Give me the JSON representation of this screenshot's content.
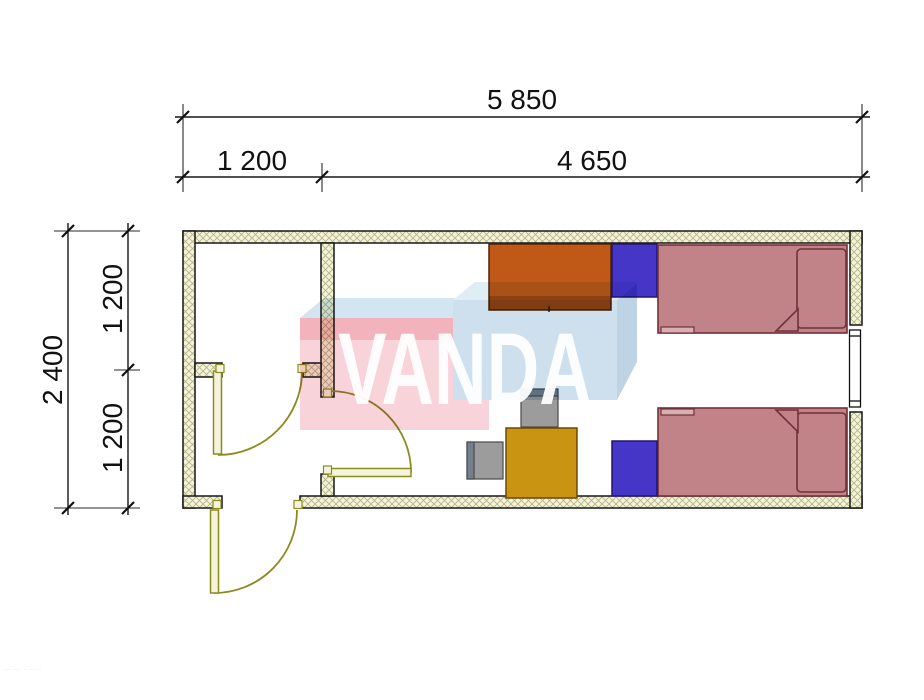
{
  "drawing": {
    "type": "floor-plan",
    "watermark": {
      "text": "VANDA",
      "letters_color": "#ffffff",
      "pink_front": "#f8cfd6",
      "pink_band": "#f2abb5",
      "pink_top": "#cfe2ef",
      "blue_front": "#c9dcec",
      "blue_top": "#dcebf4",
      "blue_side": "#b7d0e2"
    },
    "dimensions": {
      "top_total": "5 850",
      "top_segment_left": "1 200",
      "top_segment_right": "4 650",
      "side_total": "2 400",
      "side_segment_upper": "1 200",
      "side_segment_lower": "1 200"
    },
    "fine_print": "···· ··· ·· ·· ··",
    "palette": {
      "wall_fill": "#f4f4dc",
      "wall_hatch": "#b5b583",
      "wall_outline": "#161616",
      "door_line": "#8b8b1f",
      "bed_fill": "#c18387",
      "bed_outline": "#703238",
      "bed_step_fill": "#d8b0b2",
      "wardrobe_fill": "#c05818",
      "wardrobe_outline": "#4f2408",
      "cabinet_fill": "#4636c8",
      "cabinet_outline": "#241473",
      "desk_fill": "#c89412",
      "desk_outline": "#6b4a00",
      "chair_fill": "#9c9c9c",
      "chair_back_fill": "#74808d",
      "chair_outline": "#4a4a4a",
      "dim_color": "#111111"
    }
  }
}
